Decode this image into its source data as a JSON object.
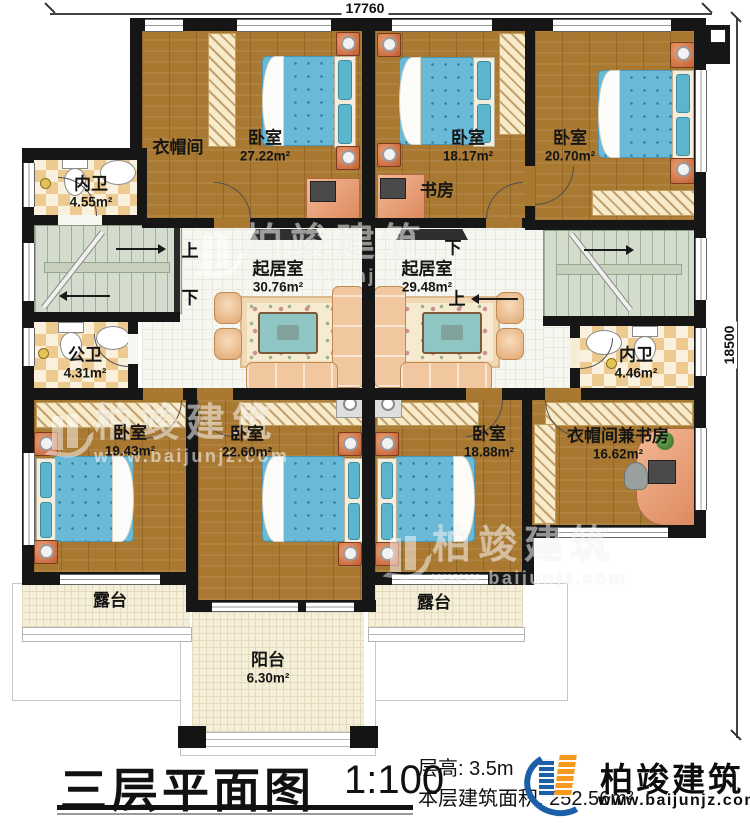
{
  "colors": {
    "wall": "#161616",
    "wood_floor": "#a97931",
    "bed_blue": "#68b8d6",
    "logo_blue": "#1b5fa8",
    "logo_orange": "#f59a1c"
  },
  "dimensions": {
    "top": "17760",
    "right": "18500"
  },
  "rooms": [
    {
      "name": "衣帽间",
      "area": ""
    },
    {
      "name": "卧室",
      "area": "27.22m²"
    },
    {
      "name": "内卫",
      "area": "4.55m²"
    },
    {
      "name": "卧室",
      "area": "18.17m²"
    },
    {
      "name": "书房",
      "area": ""
    },
    {
      "name": "卧室",
      "area": "20.70m²"
    },
    {
      "name": "起居室",
      "area": "30.76m²"
    },
    {
      "name": "起居室",
      "area": "29.48m²"
    },
    {
      "name": "公卫",
      "area": "4.31m²"
    },
    {
      "name": "内卫",
      "area": "4.46m²"
    },
    {
      "name": "卧室",
      "area": "19.43m²"
    },
    {
      "name": "卧室",
      "area": "22.60m²"
    },
    {
      "name": "卧室",
      "area": "18.88m²"
    },
    {
      "name": "衣帽间兼书房",
      "area": "16.62m²"
    },
    {
      "name": "露台",
      "area": ""
    },
    {
      "name": "露台",
      "area": ""
    },
    {
      "name": "阳台",
      "area": "6.30m²"
    }
  ],
  "stairs": {
    "left_up": "上",
    "left_down": "下",
    "right_down": "下",
    "right_up": "上"
  },
  "watermark": {
    "brand": "柏竣建筑",
    "url": "www.baijunjz.com"
  },
  "title_block": {
    "title": "三层平面图",
    "scale": "1:100",
    "floor_height": "层高: 3.5m",
    "floor_area": "本层建筑面积: 252.56m²"
  },
  "logo": {
    "brand": "柏竣建筑",
    "url": "www.baijunjz.com"
  }
}
